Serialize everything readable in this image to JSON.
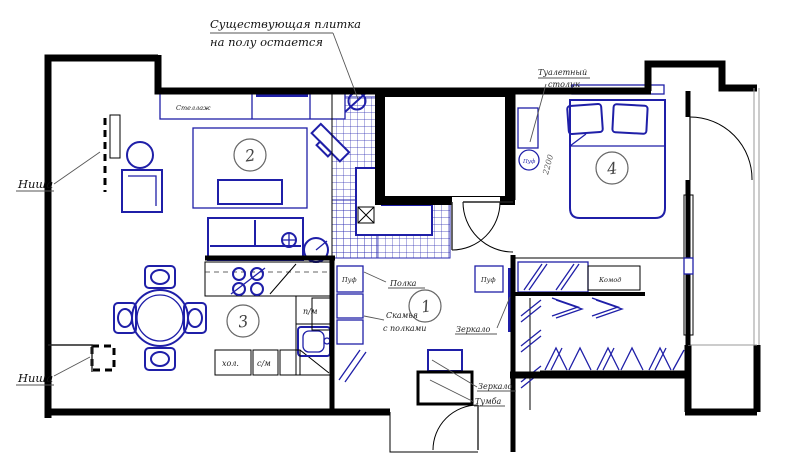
{
  "title": "apartment-floor-plan",
  "colors": {
    "wall": "#000000",
    "furniture_blue": "#1f1fa8",
    "tile_blue": "#2a2ab0",
    "label_text": "#222222"
  },
  "annotations": {
    "existing_tile_line1": "Существующая плитка",
    "existing_tile_line2": "на полу остается",
    "niche_top": "Ниша",
    "niche_bottom": "Ниша"
  },
  "rooms": {
    "hallway": "1",
    "living": "2",
    "kitchen": "3",
    "bedroom": "4"
  },
  "labels": {
    "shelf_unit": "Стеллаж",
    "fridge": "хол.",
    "washer": "с/м",
    "dishwasher": "п/м",
    "pouf_hall_left": "Пуф",
    "pouf_hall_right": "Пуф",
    "shelf_hall": "Полка",
    "bench_line1": "Скамья",
    "bench_line2": "с полками",
    "mirror_wardrobe": "Зеркало",
    "dresser": "Комод",
    "pouf_bedroom": "Пуф",
    "dressing_table_line1": "Туалетный",
    "dressing_table_line2": "столик",
    "dim_2200": "2200",
    "mirror_entry": "Зеркало",
    "cabinet_entry": "Тумба"
  }
}
